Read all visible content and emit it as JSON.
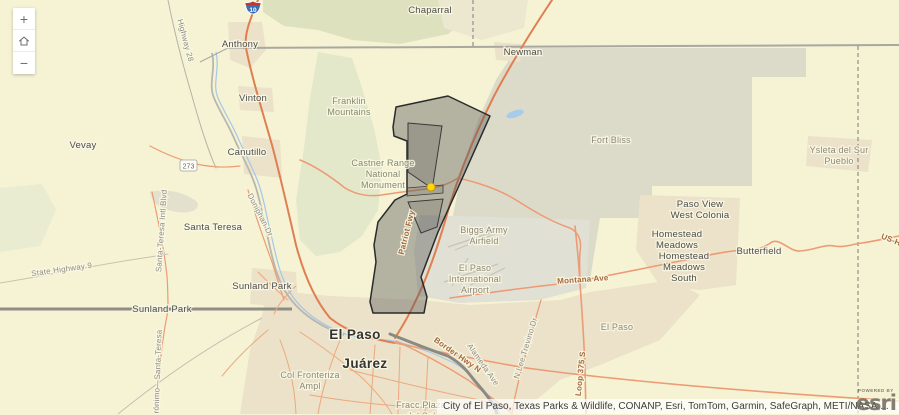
{
  "controls": {
    "zoom_in_label": "+",
    "zoom_out_label": "−"
  },
  "shields": {
    "interstate_10": "10",
    "nm_273": "273"
  },
  "map_labels": {
    "chaparral": "Chaparral",
    "anthony": "Anthony",
    "newman": "Newman",
    "vinton": "Vinton",
    "vevay": "Vevay",
    "canutillo": "Canutillo",
    "santa_teresa": "Santa Teresa",
    "sunland_park_city": "Sunland Park",
    "sunland_park_border": "Sunland Park",
    "butterfield": "Butterfield",
    "fort_bliss": "Fort Bliss",
    "el_paso_area": "El Paso",
    "el_paso_city": "El Paso",
    "juarez": "Juárez",
    "franklin": {
      "l1": "Franklin",
      "l2": "Mountains"
    },
    "castner": {
      "l1": "Castner Range",
      "l2": "National",
      "l3": "Monument"
    },
    "biggs": {
      "l1": "Biggs Army",
      "l2": "Airfield"
    },
    "airport": {
      "l1": "El Paso",
      "l2": "International",
      "l3": "Airport"
    },
    "ysleta": {
      "l1": "Ysleta del Sur",
      "l2": "Pueblo"
    },
    "paso_view": {
      "l1": "Paso View",
      "l2": "West Colonia"
    },
    "homestead": {
      "l1": "Homestead",
      "l2": "Meadows"
    },
    "homestead_south": {
      "l1": "Homestead",
      "l2": "Meadows",
      "l3": "South"
    },
    "col_fronteriza": {
      "l1": "Col Fronteriza",
      "l2": "Ampl"
    },
    "fracc_plaza": {
      "l1": "Fracc Plaza",
      "l2": "del Sol"
    }
  },
  "road_labels": {
    "montana_ave": "Montana Ave",
    "loop_375": "Loop 375 S",
    "patriot_fwy": "Patriot Fwy",
    "border_hwy": "Border Hwy N",
    "alameda_ave": "Alameda Ave",
    "lee_trevino": "N Lee Trevino Dr",
    "highway_28": "Highway 28",
    "state_highway_9": "State Highway 9",
    "santa_teresa_blvd": "Santa-Teresa Intl Blvd",
    "doniphan_dr": "Doniphan Dr",
    "us_highway": "US-H",
    "jeronimo": "Jerónimo—Santa-Teresa"
  },
  "attribution": {
    "text": "City of El Paso, Texas Parks & Wildlife, CONANP, Esri, TomTom, Garmin, SafeGraph, METI/NASA,...",
    "powered_by": "POWERED BY",
    "esri_logo": "esri"
  },
  "colors": {
    "land": "#f5f3d4",
    "military_gray": "#dcdbca",
    "urban_tan": "#ebe2c9",
    "mountain_green": "#e3e8cb",
    "road_orange": "#ec9b74",
    "overlay_stroke": "#2a2a2a",
    "marker_yellow": "#ffd60a",
    "water_blue": "#a9cbea"
  }
}
